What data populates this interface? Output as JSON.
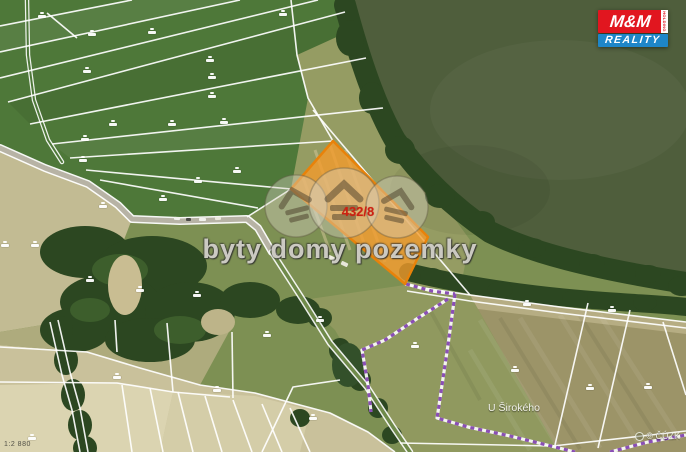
{
  "watermark": {
    "text": "byty domy pozemky"
  },
  "logo": {
    "mm": "M&M",
    "holding": "HOLDING",
    "reality": "REALITY",
    "red": "#E1161F",
    "blue": "#1E86C8"
  },
  "map": {
    "highlight_parcel": {
      "number": "432/8",
      "fill_color": "#F59B2A",
      "border_color": "#E8820A",
      "number_color": "#CE2012"
    },
    "place_label": "U Širokého",
    "attribution": "© ČÚZK",
    "scale_label": "1:2 880",
    "cadastre_line_color": "#FFFFFF",
    "disputed_line_color": "#8A4FB5",
    "parcel_markers": [
      [
        42,
        16
      ],
      [
        92,
        34
      ],
      [
        152,
        32
      ],
      [
        210,
        60
      ],
      [
        87,
        71
      ],
      [
        212,
        77
      ],
      [
        212,
        96
      ],
      [
        113,
        124
      ],
      [
        172,
        124
      ],
      [
        224,
        122
      ],
      [
        85,
        139
      ],
      [
        83,
        160
      ],
      [
        237,
        171
      ],
      [
        198,
        181
      ],
      [
        163,
        199
      ],
      [
        103,
        206
      ],
      [
        283,
        14
      ],
      [
        527,
        304
      ],
      [
        612,
        310
      ],
      [
        515,
        370
      ],
      [
        590,
        388
      ],
      [
        648,
        387
      ],
      [
        415,
        346
      ],
      [
        320,
        320
      ],
      [
        90,
        280
      ],
      [
        140,
        290
      ],
      [
        197,
        295
      ],
      [
        267,
        335
      ],
      [
        117,
        377
      ],
      [
        217,
        390
      ],
      [
        32,
        438
      ],
      [
        313,
        418
      ],
      [
        5,
        245
      ],
      [
        35,
        245
      ]
    ]
  }
}
